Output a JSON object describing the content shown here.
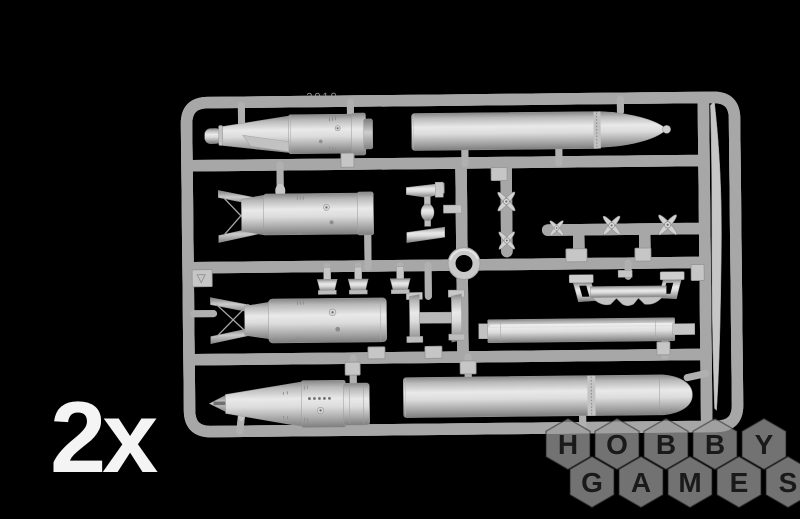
{
  "colors": {
    "background": "#000000",
    "sprue_plastic": "#cdcdcd",
    "watermark_hexagon": "#9e9e9e",
    "watermark_letters": "#1a1a1a",
    "quantity_text": "#f4f4f4"
  },
  "quantity_label": "2x",
  "sprue_molded_marking": "2010",
  "watermark": {
    "row1": [
      "H",
      "O",
      "B",
      "B",
      "Y"
    ],
    "row2": [
      "G",
      "A",
      "M",
      "E",
      "S"
    ]
  }
}
